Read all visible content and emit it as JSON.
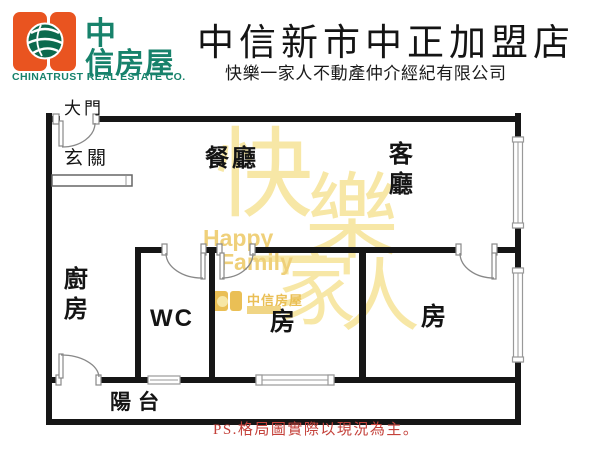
{
  "header": {
    "logo": {
      "icon": "globe-icon",
      "brand_line1": "中",
      "brand_line2": "信房屋",
      "company_en": "CHINATRUST REAL ESTATE CO."
    },
    "title": "中信新市中正加盟店",
    "subtitle": "快樂一家人不動產仲介經紀有限公司"
  },
  "floorplan": {
    "labels": {
      "main_door": "大門",
      "entry": "玄關",
      "dining": "餐廳",
      "living": "客廳",
      "kitchen": "廚房",
      "wc": "WC",
      "bedroom_middle": "房",
      "bedroom_right": "房",
      "balcony": "陽台"
    },
    "note": "PS.格局圖實際以現況為主。"
  },
  "watermark": {
    "big_chars": [
      "快",
      "樂",
      "一",
      "家",
      "人"
    ],
    "en_line1": "Happy",
    "en_line2": "Family",
    "mini_logo_text": "中信房屋"
  },
  "colors": {
    "logo_orange": "#e95420",
    "brand_green": "#17826b",
    "globe_green": "#0c6a4e",
    "note_red": "#c4413a",
    "wall_black": "#161616",
    "watermark_light": "#f7e7a6",
    "watermark_mid": "#efd07a",
    "watermark_deep": "#eabf55"
  }
}
